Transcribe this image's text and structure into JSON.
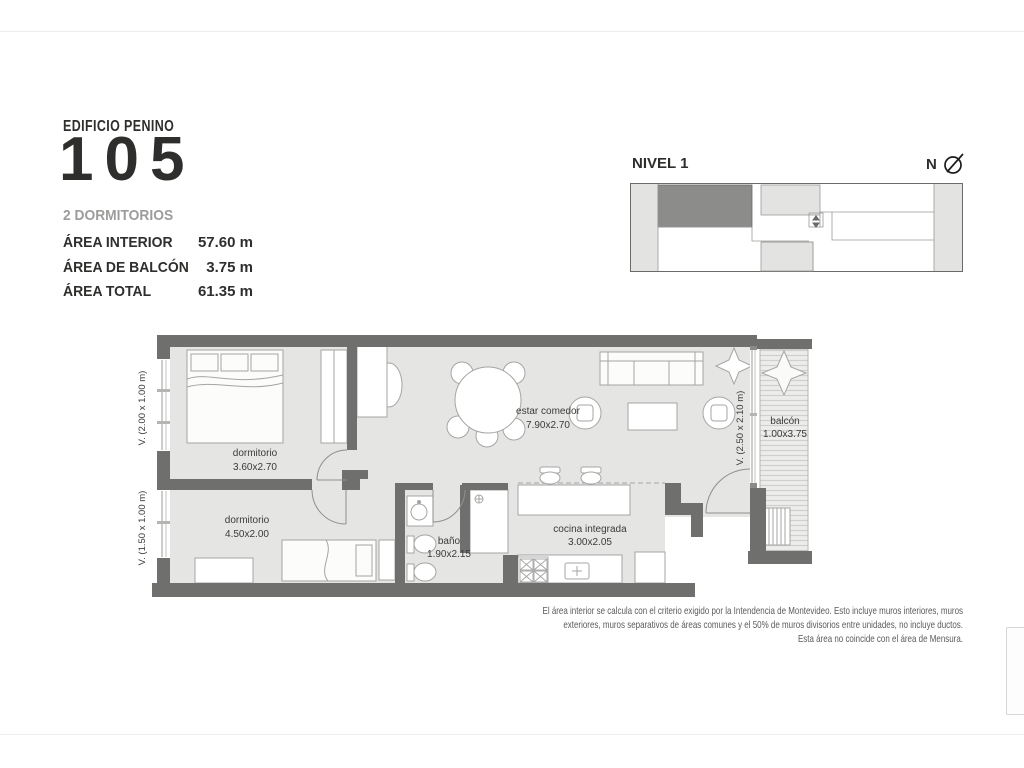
{
  "title": {
    "building": "EDIFICIO PENINO",
    "unit": "105"
  },
  "summary": {
    "type_label": "2 DORMITORIOS",
    "areas": [
      {
        "label": "ÁREA INTERIOR",
        "value": "57.60 m"
      },
      {
        "label": "ÁREA DE BALCÓN",
        "value": "3.75 m"
      },
      {
        "label": "ÁREA TOTAL",
        "value": "61.35 m"
      }
    ]
  },
  "keyplan": {
    "level": "NIVEL 1",
    "north": "N"
  },
  "plan": {
    "rooms": [
      {
        "name": "dormitorio",
        "dims": "3.60x2.70"
      },
      {
        "name": "dormitorio",
        "dims": "4.50x2.00"
      },
      {
        "name": "estar comedor",
        "dims": "7.90x2.70"
      },
      {
        "name": "baño",
        "dims": "1.90x2.15"
      },
      {
        "name": "cocina integrada",
        "dims": "3.00x2.05"
      },
      {
        "name": "balcón",
        "dims": "1.00x3.75"
      }
    ],
    "windows": [
      "V. (2.00 x 1.00 m)",
      "V. (1.50 x 1.00 m)",
      "V. (2.50 x 2.10 m)"
    ]
  },
  "disclaimer": {
    "lines": [
      "El área interior se calcula con el criterio exigido por la Intendencia de Montevideo. Esto incluye muros interiores, muros",
      "exteriores, muros separativos de áreas comunes y el 50% de muros divisorios entre unidades, no incluye ductos.",
      "Esta área no coincide con el área de Mensura."
    ]
  },
  "colors": {
    "wall": "#6f6f6e",
    "floor": "#e5e5e4",
    "keyplan_highlight": "#8c8c8b",
    "keyplan_light": "#e3e3e2",
    "muted_text": "#9c9c9b",
    "label_text": "#3b3b3a"
  }
}
